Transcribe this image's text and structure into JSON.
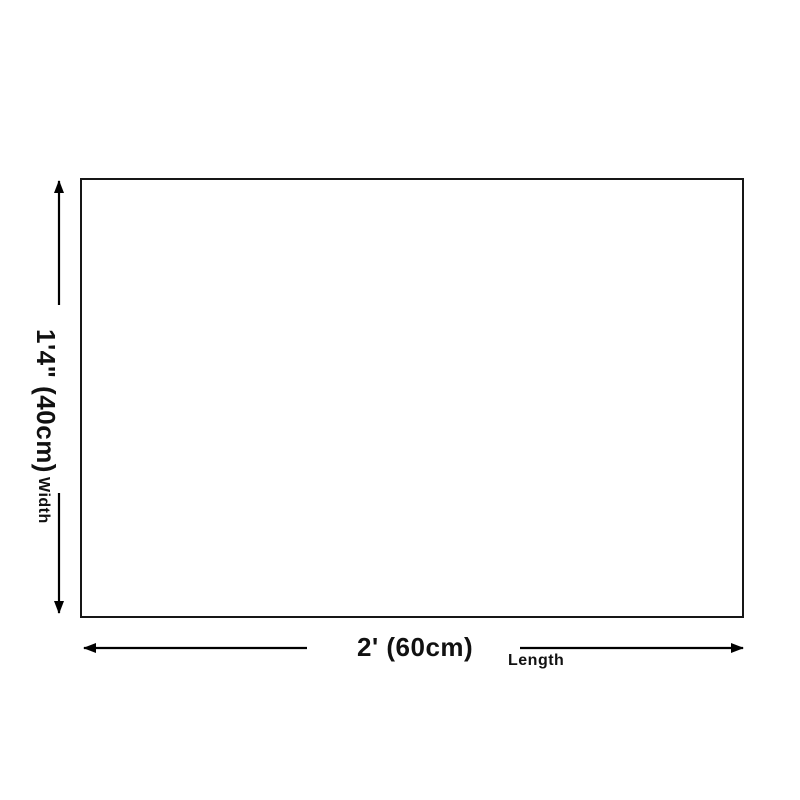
{
  "page": {
    "background_color": "#ffffff"
  },
  "diagram": {
    "type": "product-dimension-diagram",
    "rect": {
      "border_color": "#161616",
      "fill_color": "#ffffff"
    },
    "arrow_color": "#000000",
    "width_dim": {
      "value_label": "1'4\" (40cm)",
      "name_label": "Width"
    },
    "length_dim": {
      "value_label": "2' (60cm)",
      "name_label": "Length"
    }
  }
}
